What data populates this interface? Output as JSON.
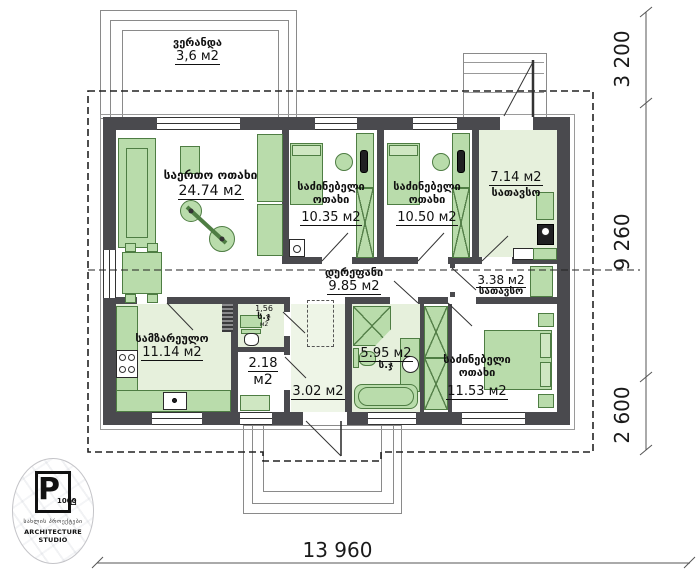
{
  "veranda": {
    "name": "ვერანდა",
    "area": "3,6 м2"
  },
  "rooms": {
    "living": {
      "name": "საერთო ოთახი",
      "area": "24.74 м2"
    },
    "bedroom1": {
      "name": "საძინებელი",
      "name2": "ოთახი",
      "area": "10.35 м2"
    },
    "bedroom2": {
      "name": "საძინებელი",
      "name2": "ოთახი",
      "area": "10.50 м2"
    },
    "storage_top": {
      "area": "7.14 м2",
      "name": "სათავსო"
    },
    "corridor": {
      "name": "დერეფანი",
      "area": "9.85 м2"
    },
    "storage_small": {
      "area": "3.38 м2",
      "name": "სათავსო"
    },
    "kitchen": {
      "name": "სამზარეულო",
      "area": "11.14 м2"
    },
    "wc": {
      "area": "1,56",
      "name": "ს.ჯ",
      "unit": "м2"
    },
    "hall": {
      "area": "2.18",
      "unit": "м2"
    },
    "vestibule": {
      "area": "3.02 м2"
    },
    "bathroom": {
      "area": "5.95 м2",
      "name": "ს.ჯ"
    },
    "bedroom3": {
      "name": "საძინებელი",
      "name2": "ოთახი",
      "area": "11.53 м2"
    }
  },
  "dimensions": {
    "right_top": "3 200",
    "right_middle": "9 260",
    "right_bottom": "2 600",
    "bottom": "13 960"
  },
  "logo": {
    "letter": "P",
    "number": "1000",
    "house_icon": "⌂",
    "tagline_georgian": "სახლის პროექტები",
    "tagline_english": "ARCHITECTURE STUDIO"
  },
  "colors": {
    "wall": "#4a4a4e",
    "furniture": "#b9dcab",
    "floor": "#e6f0dc"
  }
}
